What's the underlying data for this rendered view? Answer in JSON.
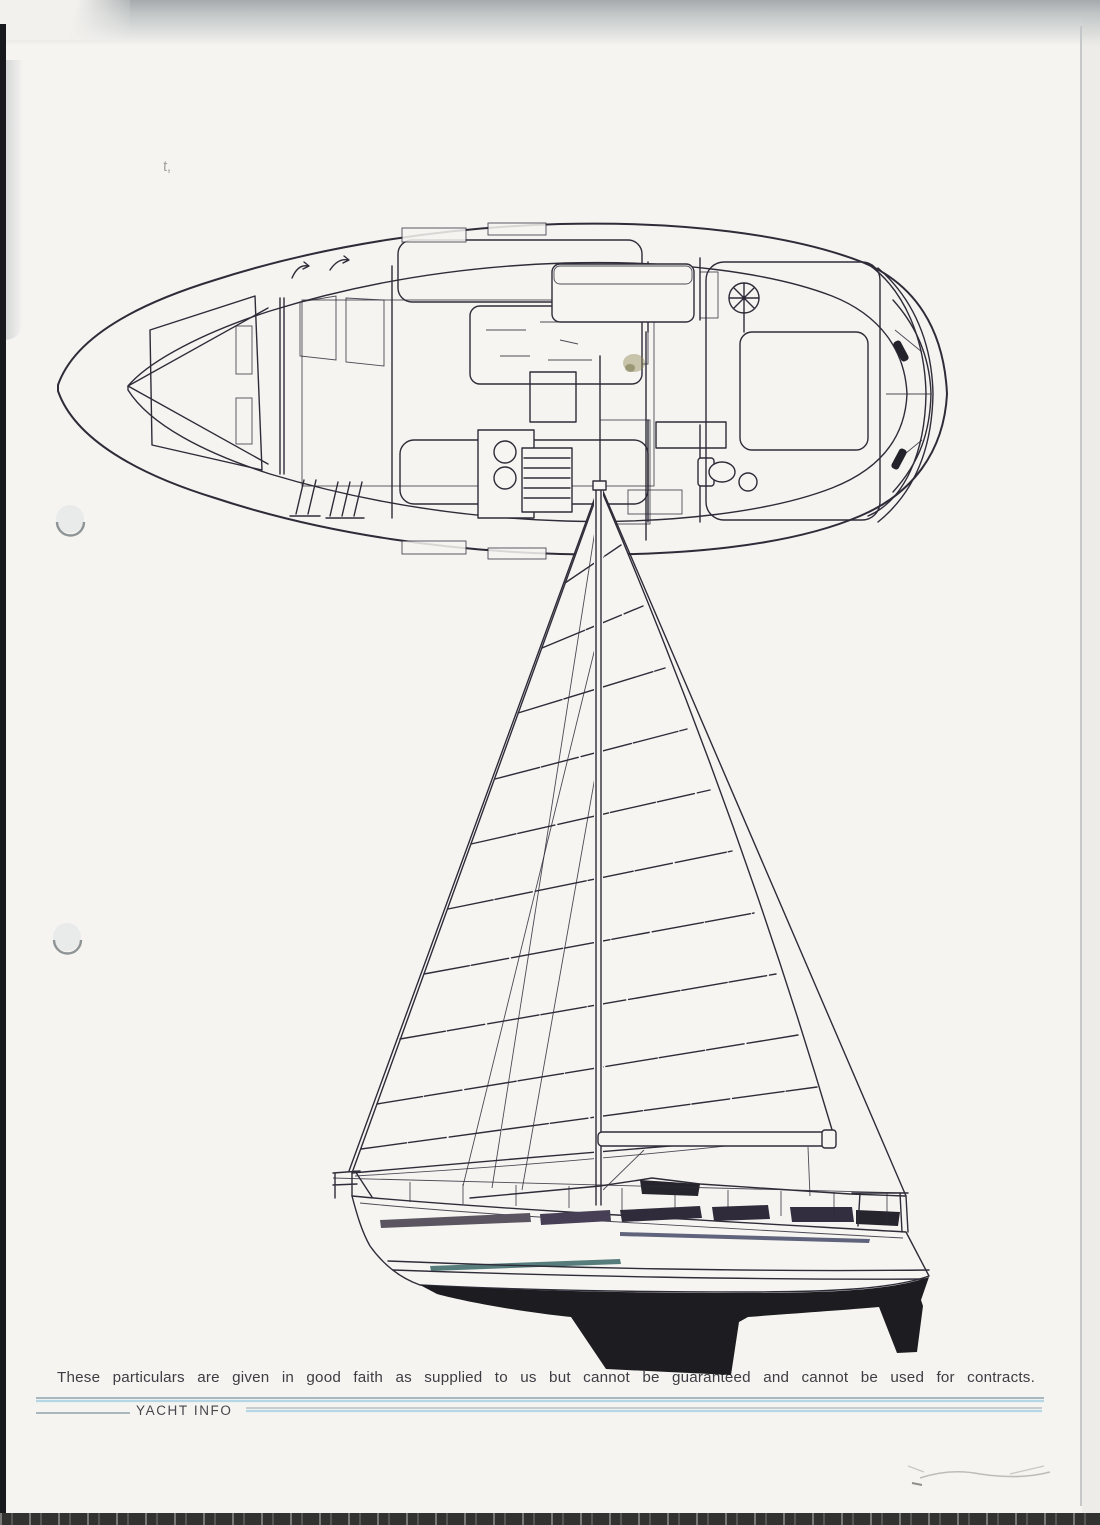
{
  "page": {
    "paper_color": "#f5f4f1",
    "ink_color": "#2e2c38",
    "hull_fill_color": "#1d1c20",
    "accent_rule_color": "#b5d7e5",
    "disclaimer": "These particulars are given in good faith as supplied to us but cannot be guaranteed and cannot be used for contracts.",
    "footer_label": "YACHT INFO",
    "stray_mark": "t,"
  }
}
